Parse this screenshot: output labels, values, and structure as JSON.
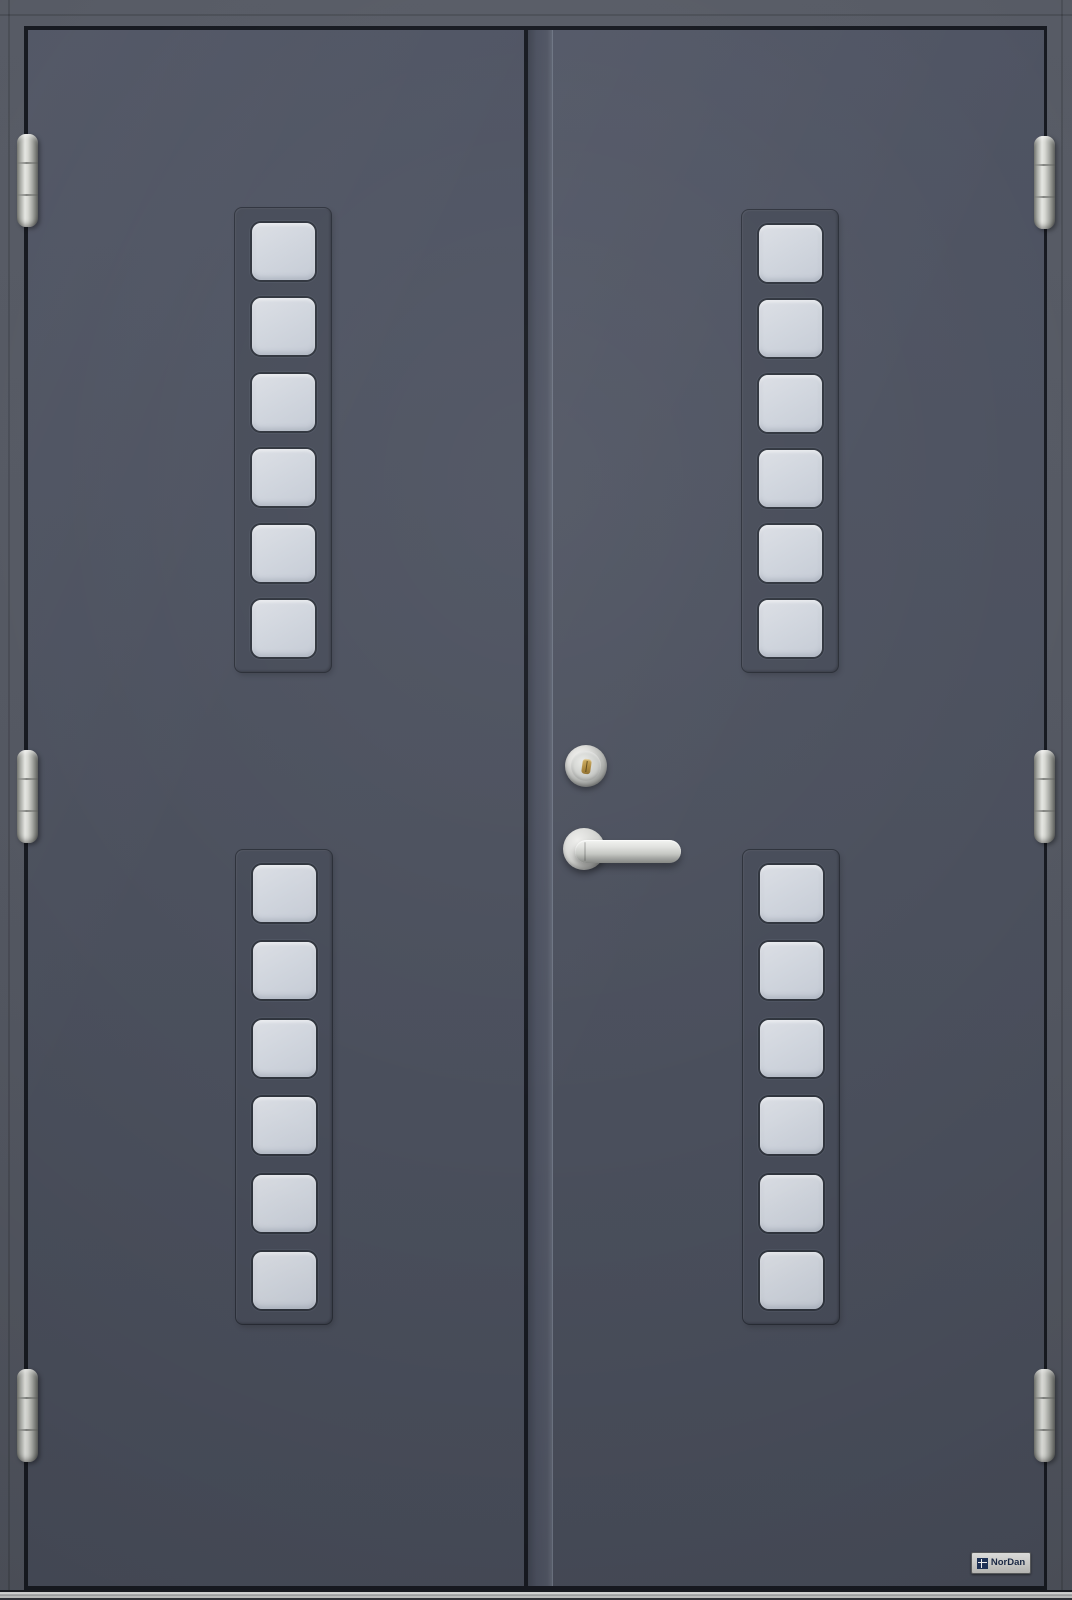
{
  "meta": {
    "type": "product-photo",
    "subject": "Double exterior front door, anthracite grey, with two vertical strips of six square glass panes per leaf"
  },
  "brand": {
    "label": "NorDan"
  },
  "door": {
    "leaves": 2,
    "glazing": {
      "units": [
        "top-left",
        "bottom-left",
        "top-right",
        "bottom-right"
      ],
      "panes_per_unit": 6,
      "total_panes": 24,
      "pane_shape": "rounded-square"
    },
    "hardware": {
      "hinges": 6,
      "lock_cylinder": "stainless cylinder with brass keyway",
      "handle": "stainless lever handle on round rose"
    },
    "colors": {
      "leaf": "#4b505d",
      "frame": "#555963",
      "reveal_gap": "#171a21",
      "glass": "#ccd2da",
      "stainless": "#d9dad7",
      "brass": "#ad8c3e",
      "threshold": "#c9cac9",
      "logo_plate": "#d6d6d3",
      "logo_text": "#1c2b49"
    }
  }
}
